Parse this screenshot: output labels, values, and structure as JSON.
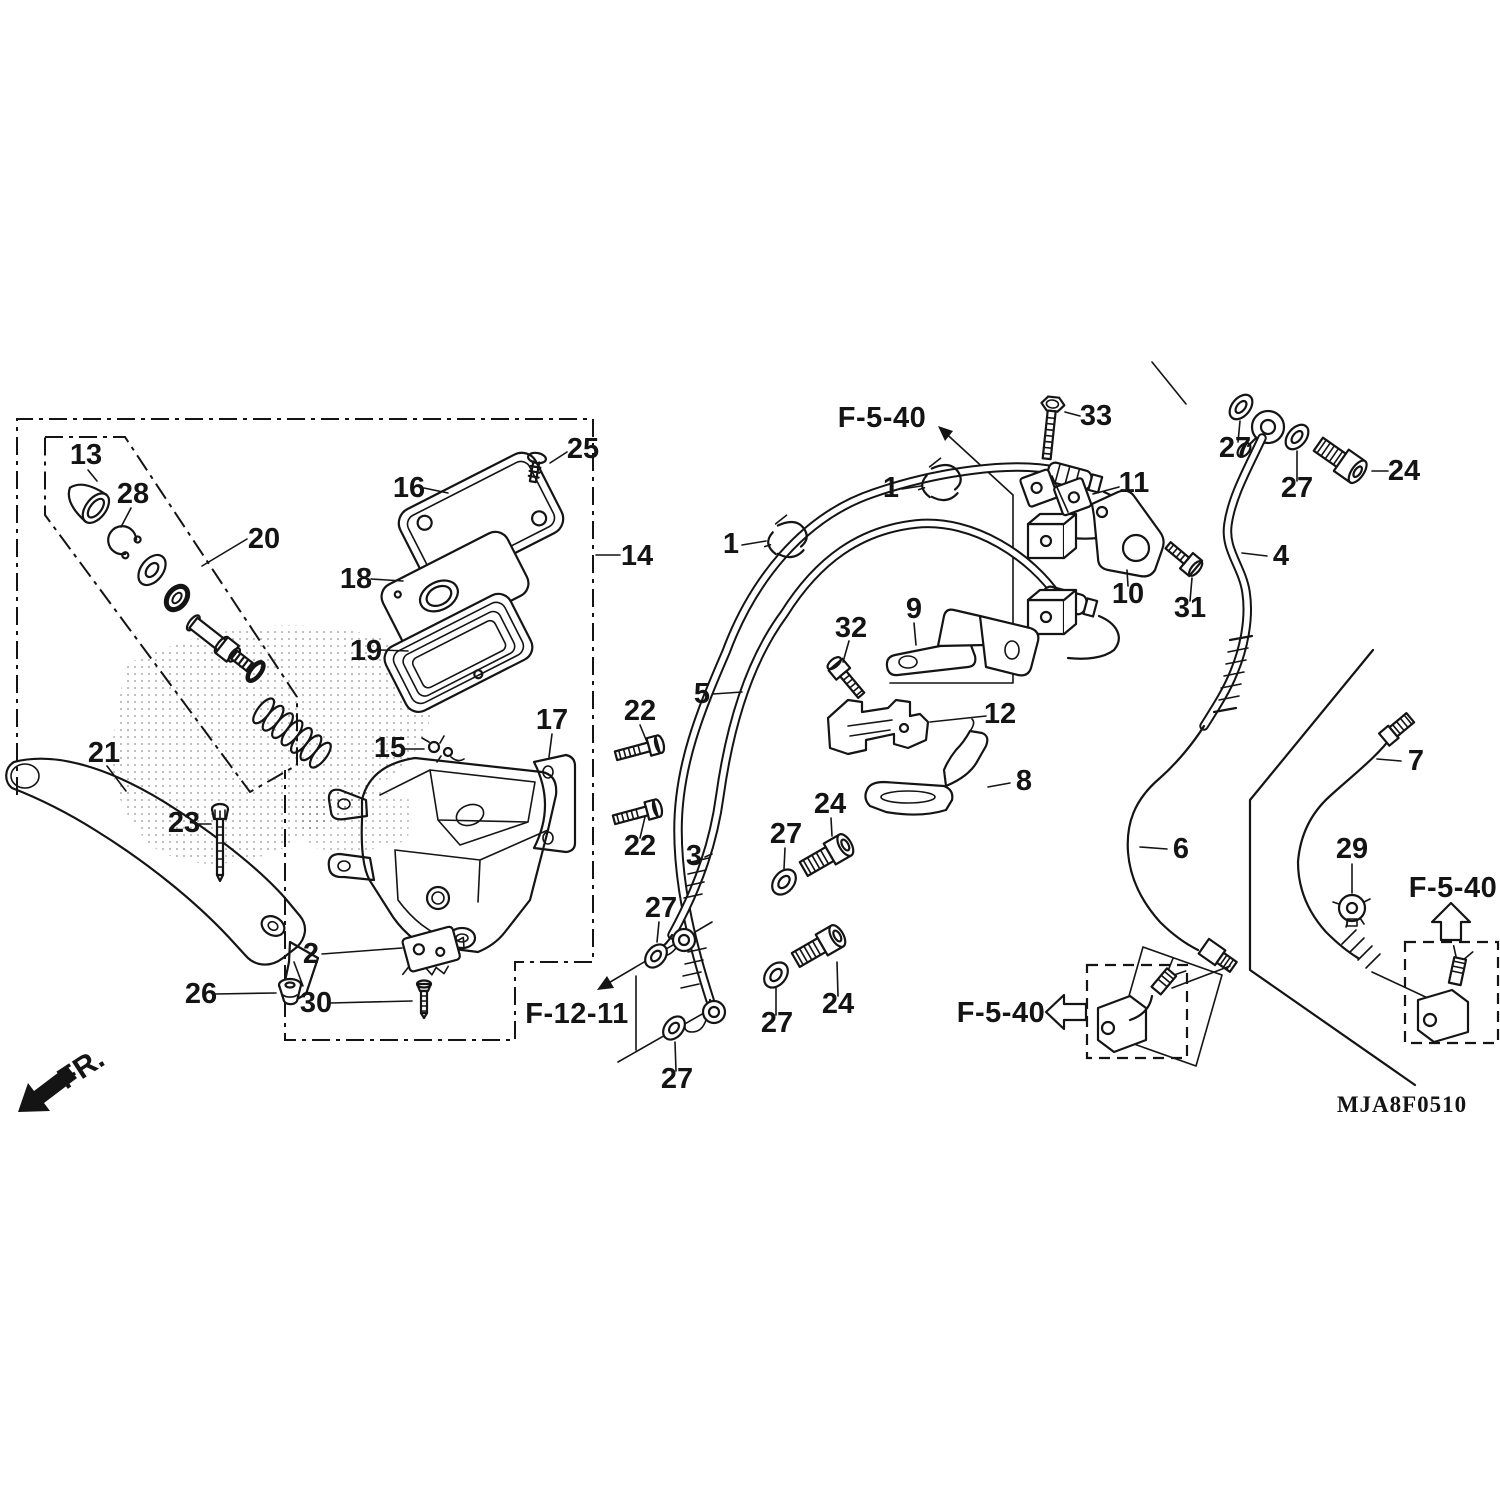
{
  "diagram_code": "MJA8F0510",
  "orientation": {
    "label": "FR."
  },
  "figure_refs": [
    {
      "label": "F-5-40",
      "x": 882,
      "y": 427
    },
    {
      "label": "F-12-11",
      "x": 577,
      "y": 1023
    },
    {
      "label": "F-5-40",
      "x": 1001,
      "y": 1022
    },
    {
      "label": "F-5-40",
      "x": 1453,
      "y": 897
    }
  ],
  "callouts": [
    {
      "part": "13",
      "x": 86,
      "y": 464,
      "leader": [
        88,
        470,
        97,
        481
      ]
    },
    {
      "part": "28",
      "x": 133,
      "y": 503,
      "leader": [
        131,
        508,
        121,
        527
      ]
    },
    {
      "part": "20",
      "x": 264,
      "y": 548,
      "leader": [
        247,
        539,
        202,
        566
      ]
    },
    {
      "part": "16",
      "x": 409,
      "y": 497,
      "leader": [
        424,
        488,
        448,
        493
      ]
    },
    {
      "part": "25",
      "x": 583,
      "y": 458,
      "leader": [
        567,
        452,
        550,
        463
      ]
    },
    {
      "part": "14",
      "x": 637,
      "y": 565,
      "leader": [
        596,
        555,
        620,
        555
      ]
    },
    {
      "part": "18",
      "x": 356,
      "y": 588,
      "leader": [
        371,
        579,
        403,
        581
      ]
    },
    {
      "part": "19",
      "x": 366,
      "y": 660,
      "leader": [
        381,
        650,
        408,
        651
      ]
    },
    {
      "part": "17",
      "x": 552,
      "y": 729,
      "leader": [
        552,
        734,
        549,
        757
      ]
    },
    {
      "part": "15",
      "x": 390,
      "y": 757,
      "leader": [
        403,
        749,
        424,
        749
      ]
    },
    {
      "part": "22",
      "x": 640,
      "y": 720,
      "leader": [
        640,
        725,
        647,
        742
      ]
    },
    {
      "part": "22",
      "x": 640,
      "y": 855,
      "leader": [
        640,
        838,
        645,
        817
      ]
    },
    {
      "part": "21",
      "x": 104,
      "y": 762,
      "leader": [
        107,
        766,
        126,
        791
      ]
    },
    {
      "part": "23",
      "x": 184,
      "y": 832,
      "leader": [
        197,
        824,
        211,
        824
      ]
    },
    {
      "part": "2",
      "x": 311,
      "y": 963,
      "leader": [
        322,
        954,
        402,
        948
      ]
    },
    {
      "part": "26",
      "x": 201,
      "y": 1003,
      "leader": [
        215,
        994,
        276,
        993
      ]
    },
    {
      "part": "30",
      "x": 316,
      "y": 1012,
      "leader": [
        330,
        1003,
        412,
        1001
      ]
    },
    {
      "part": "1",
      "x": 731,
      "y": 553,
      "leader": [
        742,
        545,
        766,
        541
      ]
    },
    {
      "part": "1",
      "x": 891,
      "y": 497,
      "leader": [
        902,
        489,
        921,
        486
      ]
    },
    {
      "part": "5",
      "x": 702,
      "y": 703,
      "leader": [
        713,
        694,
        742,
        692
      ]
    },
    {
      "part": "3",
      "x": 694,
      "y": 865,
      "leader": [
        705,
        857,
        712,
        854
      ]
    },
    {
      "part": "9",
      "x": 914,
      "y": 618,
      "leader": [
        914,
        623,
        916,
        645
      ]
    },
    {
      "part": "32",
      "x": 851,
      "y": 637,
      "leader": [
        849,
        641,
        843,
        662
      ]
    },
    {
      "part": "12",
      "x": 1000,
      "y": 723,
      "leader": [
        986,
        716,
        930,
        722
      ]
    },
    {
      "part": "8",
      "x": 1024,
      "y": 790,
      "leader": [
        1010,
        783,
        988,
        787
      ]
    },
    {
      "part": "33",
      "x": 1096,
      "y": 425,
      "leader": [
        1080,
        416,
        1065,
        412
      ]
    },
    {
      "part": "11",
      "x": 1134,
      "y": 492,
      "leader": [
        1119,
        487,
        1093,
        494
      ]
    },
    {
      "part": "10",
      "x": 1128,
      "y": 603,
      "leader": [
        1128,
        586,
        1127,
        570
      ]
    },
    {
      "part": "31",
      "x": 1190,
      "y": 617,
      "leader": [
        1190,
        601,
        1192,
        578
      ]
    },
    {
      "part": "27",
      "x": 1235,
      "y": 457,
      "leader": [
        1238,
        442,
        1240,
        421
      ]
    },
    {
      "part": "27",
      "x": 1297,
      "y": 497,
      "leader": [
        1297,
        481,
        1297,
        451
      ]
    },
    {
      "part": "24",
      "x": 1404,
      "y": 480,
      "leader": [
        1388,
        471,
        1372,
        471
      ]
    },
    {
      "part": "4",
      "x": 1281,
      "y": 565,
      "leader": [
        1267,
        556,
        1242,
        553
      ]
    },
    {
      "part": "27",
      "x": 661,
      "y": 917,
      "leader": [
        659,
        922,
        657,
        942
      ]
    },
    {
      "part": "27",
      "x": 786,
      "y": 843,
      "leader": [
        785,
        848,
        784,
        869
      ]
    },
    {
      "part": "24",
      "x": 830,
      "y": 813,
      "leader": [
        831,
        818,
        832,
        836
      ]
    },
    {
      "part": "27",
      "x": 777,
      "y": 1032,
      "leader": [
        776,
        1015,
        776,
        988
      ]
    },
    {
      "part": "24",
      "x": 838,
      "y": 1013,
      "leader": [
        838,
        996,
        837,
        962
      ]
    },
    {
      "part": "27",
      "x": 677,
      "y": 1088,
      "leader": [
        676,
        1071,
        675,
        1042
      ]
    },
    {
      "part": "6",
      "x": 1181,
      "y": 858,
      "leader": [
        1167,
        849,
        1140,
        847
      ]
    },
    {
      "part": "29",
      "x": 1352,
      "y": 858,
      "leader": [
        1352,
        864,
        1352,
        893
      ]
    },
    {
      "part": "7",
      "x": 1416,
      "y": 770,
      "leader": [
        1401,
        761,
        1377,
        759
      ]
    }
  ]
}
